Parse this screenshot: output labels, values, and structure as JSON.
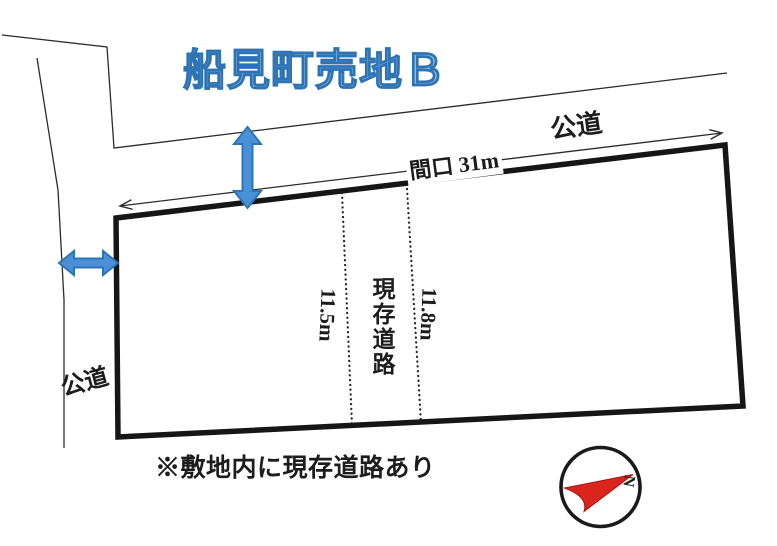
{
  "title": "船見町売地Ｂ",
  "roads": {
    "top": {
      "label": "公道"
    },
    "left": {
      "label": "公道"
    },
    "frontage_label": "間口 31m"
  },
  "existing_road": {
    "label": "現存道路",
    "width_left": "11.5m",
    "width_right": "11.8m"
  },
  "note": "※敷地内に現存道路あり",
  "compass": {
    "north": "N"
  },
  "colors": {
    "title_fill": "#9CC2E5",
    "title_outline": "#2E74B5",
    "arrow_fill": "#4A90D8",
    "arrow_outline": "#2E74B5",
    "compass_red": "#D9251C",
    "ink": "#1C1C1C"
  }
}
